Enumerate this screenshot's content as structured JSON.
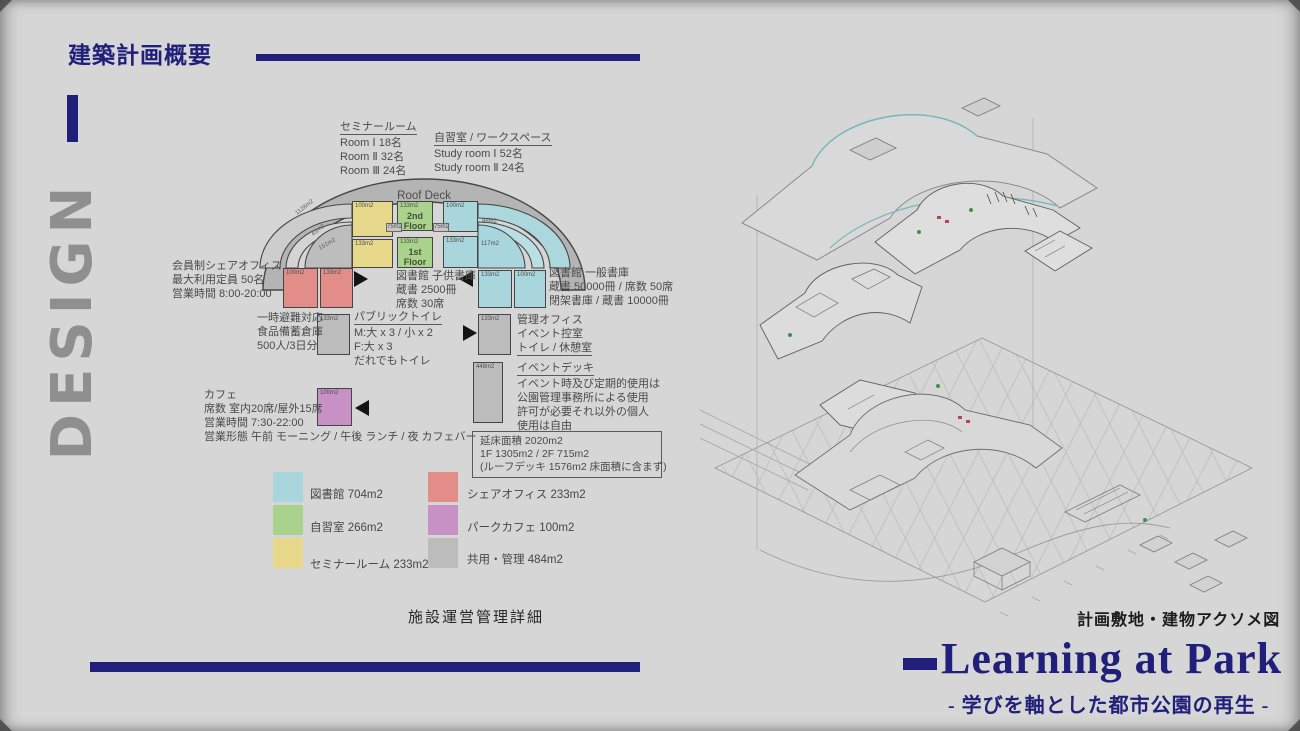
{
  "header": {
    "title": "建築計画概要"
  },
  "side_label": "DESIGN",
  "colors": {
    "accent": "#20207b",
    "library": "#a9d6dc",
    "study": "#a9d28d",
    "seminar": "#e7d88b",
    "share_office": "#e28d88",
    "cafe": "#c791c6",
    "common": "#bcbcbc"
  },
  "diagram": {
    "roof_deck": "Roof Deck",
    "floor_2": "2nd Floor",
    "floor_1": "1st Floor",
    "areas": {
      "arc_outer": "1128m2",
      "arc_mid": "43m2",
      "arc_inner": "151m2",
      "seminar_2f": "100m2",
      "seminar_1f": "133m2",
      "study_2f": "133m2",
      "study_1f": "133m2",
      "conn_left": "75m2",
      "conn_right": "75m2",
      "library_2f": "100m2",
      "library_1f": "133m2",
      "library_ring": "88m2",
      "library_quarter": "117m2",
      "library_low_left": "133m2",
      "library_low_right": "100m2",
      "share_left": "100m2",
      "share_right": "133m2",
      "toilet": "133m2",
      "admin": "133m2",
      "event_deck": "448m2",
      "cafe": "100m2"
    }
  },
  "notes": {
    "seminar": {
      "title": "セミナールーム",
      "lines": [
        "Room Ⅰ 18名",
        "Room Ⅱ 32名",
        "Room Ⅲ 24名"
      ]
    },
    "study": {
      "title": "自習室 / ワークスペース",
      "lines": [
        "Study room Ⅰ  52名",
        "Study room Ⅱ  24名"
      ]
    },
    "share_office": {
      "lines": [
        "会員制シェアオフィス",
        "最大利用定員  50名",
        "営業時間  8:00-20:00"
      ]
    },
    "children_library": {
      "lines": [
        "図書館  子供書庫",
        "蔵書  2500冊",
        "席数  30席"
      ]
    },
    "general_library": {
      "lines": [
        "図書館  一般書庫",
        "蔵書  50000冊 / 席数  50席",
        "閉架書庫 / 蔵書  10000冊"
      ]
    },
    "evacuation": {
      "lines": [
        "一時避難対応",
        "食品備蓄倉庫",
        "500人/3日分"
      ]
    },
    "public_toilet": {
      "title": "パブリックトイレ",
      "lines": [
        "M:大 x 3 / 小 x 2",
        "F:大 x 3",
        "だれでもトイレ"
      ]
    },
    "admin_office": {
      "lines": [
        "管理オフィス",
        "イベント控室",
        "トイレ / 休憩室"
      ]
    },
    "event_deck": {
      "title": "イベントデッキ",
      "lines": [
        "イベント時及び定期的使用は",
        "公園管理事務所による使用",
        "許可が必要それ以外の個人",
        "使用は自由"
      ]
    },
    "cafe": {
      "lines": [
        "カフェ",
        "席数  室内20席/屋外15席",
        "営業時間  7:30-22:00",
        "営業形態  午前 モーニング / 午後 ランチ / 夜  カフェバー"
      ]
    },
    "total_area": {
      "lines": [
        "延床面積  2020m2",
        "1F 1305m2 / 2F 715m2",
        "(ルーフデッキ 1576m2 床面積に含まず)"
      ]
    }
  },
  "legend": {
    "items": [
      {
        "label": "図書館  704m2",
        "color": "#a9d6dc"
      },
      {
        "label": "自習室  266m2",
        "color": "#a9d28d"
      },
      {
        "label": "セミナールーム  233m2",
        "color": "#e7d88b"
      },
      {
        "label": "シェアオフィス  233m2",
        "color": "#e28d88"
      },
      {
        "label": "パークカフェ  100m2",
        "color": "#c791c6"
      },
      {
        "label": "共用・管理  484m2",
        "color": "#bcbcbc"
      }
    ]
  },
  "captions": {
    "left": "施設運営管理詳細",
    "right": "計画敷地・建物アクソメ図"
  },
  "footer": {
    "title": "Learning at Park",
    "subtitle": "- 学びを軸とした都市公園の再生 -"
  }
}
